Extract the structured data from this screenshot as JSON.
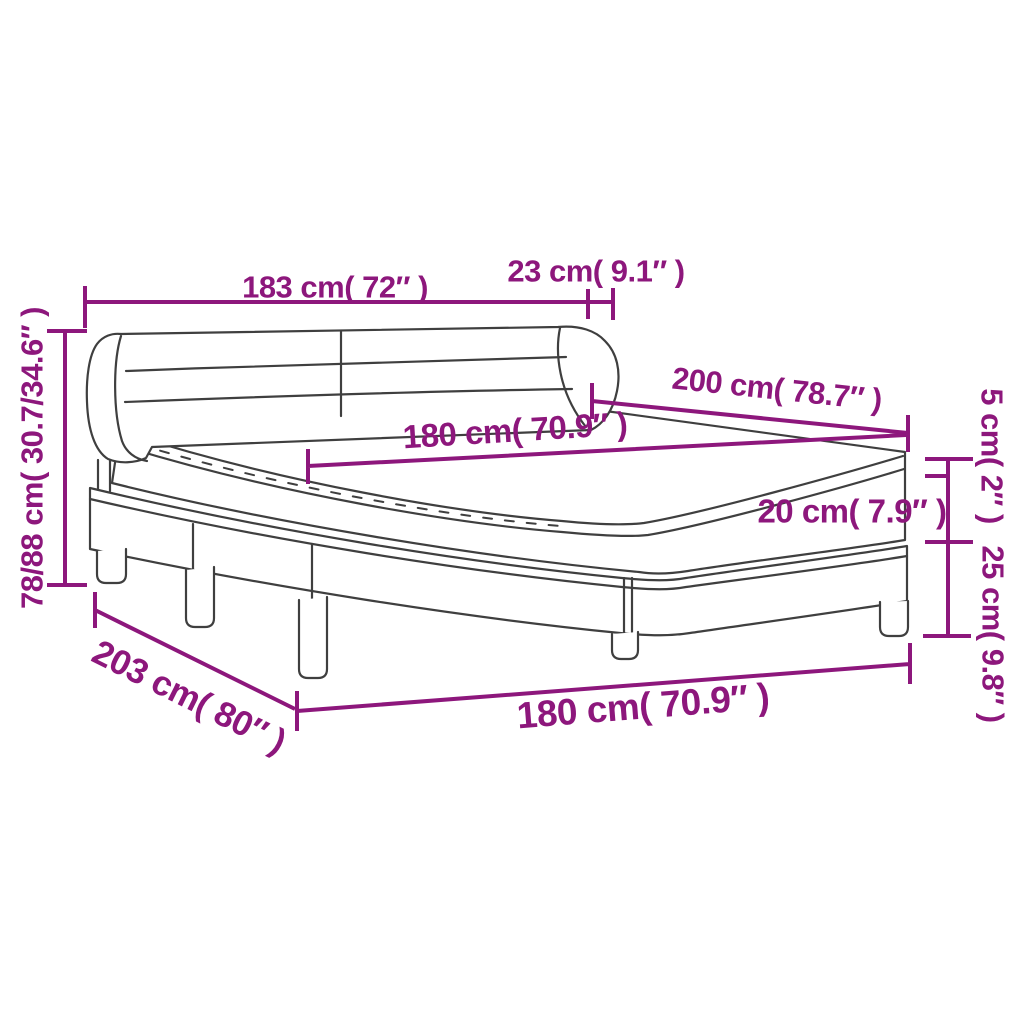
{
  "diagram": {
    "kind": "product dimension diagram",
    "subject": "box spring bed with headboard and mattress topper"
  },
  "colors": {
    "accent": "#8d177c",
    "line_art": "#3f3f3f",
    "background": "#ffffff"
  },
  "labels": {
    "headboard_width": "183 cm( 72″ )",
    "headboard_depth": "23 cm( 9.1″ )",
    "height_range": "78/88 cm( 30.7/34.6″ )",
    "bed_length": "200 cm( 78.7″ )",
    "mattress_width": "180 cm( 70.9″ )",
    "topper_thickness": "5 cm( 2″ )",
    "mattress_thickness": "20 cm( 7.9″ )",
    "base_with_legs_height": "25 cm( 9.8″ )",
    "footprint_length": "203 cm( 80″ )",
    "footprint_width": "180 cm( 70.9″ )"
  }
}
